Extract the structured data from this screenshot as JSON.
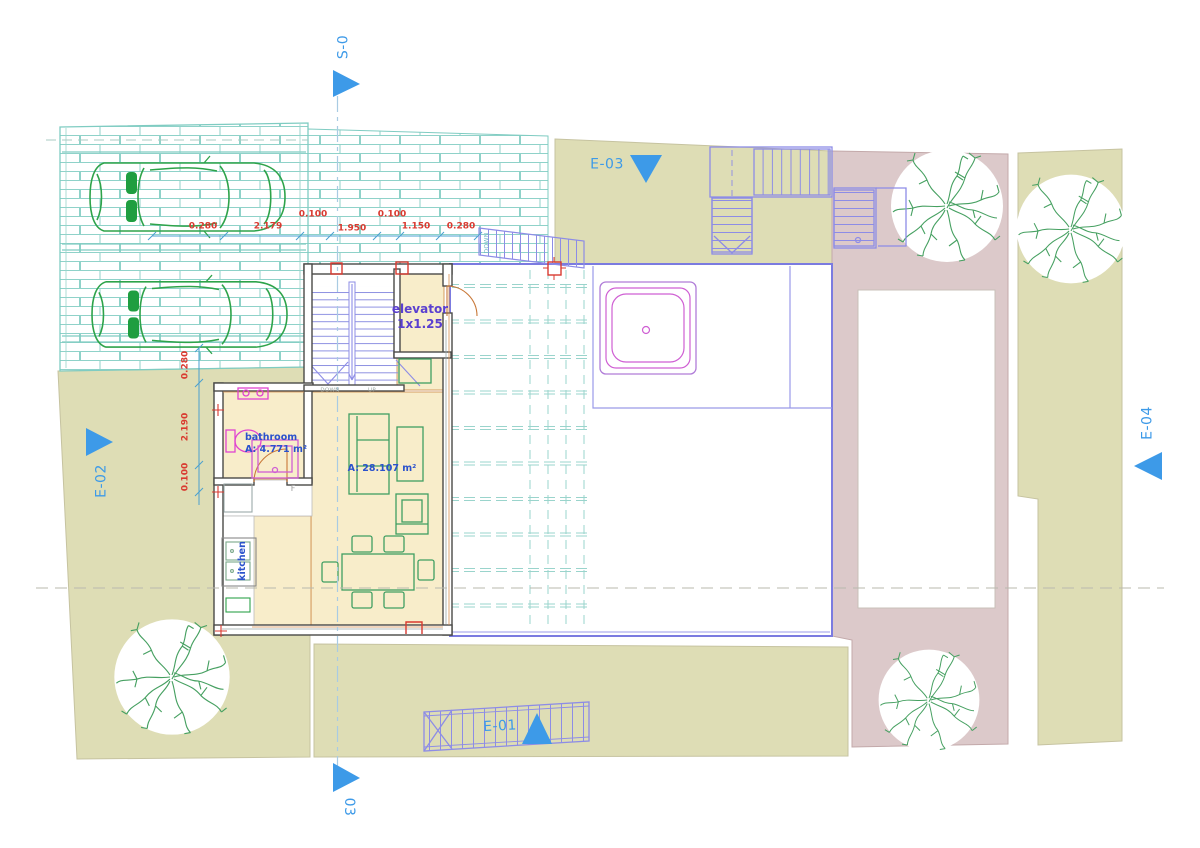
{
  "plan": {
    "markers": {
      "s_top": "S-0",
      "s_bottom": "03",
      "e01": "E-01",
      "e02": "E-02",
      "e03": "E-03",
      "e04": "E-04"
    },
    "rooms": {
      "elevator_name": "elevator",
      "elevator_size": "1x1.25",
      "bathroom_name": "bathroom",
      "bathroom_area": "A: 4.771 m²",
      "living_area": "A: 28.107 m²",
      "kitchen_name": "kitchen",
      "fridge": "F"
    },
    "stairs": {
      "down": "DOWN",
      "up": "UP",
      "down_exterior": "DOWN"
    },
    "dimensions": {
      "h": [
        "0.280",
        "2.179",
        "0.100",
        "1.950",
        "0.100",
        "1.150",
        "0.280"
      ],
      "v": [
        "0.280",
        "2.190",
        "0.100"
      ]
    },
    "colors": {
      "marker_blue": "#3d9ae8",
      "dimension_red": "#d93a30",
      "room_label_blue": "#2b52cc",
      "elevator_label_purple": "#5a3fd0",
      "site_olive": "#deddb5",
      "site_pink": "#dcc9ca",
      "floor_cream": "#f8edca",
      "line_teal": "#7fccc2",
      "line_green": "#2ea34a",
      "line_purple": "#8d8ce6",
      "line_magenta": "#cf5fd3",
      "wall_dark": "#4a4a48",
      "accent_orange": "#c87838"
    }
  }
}
